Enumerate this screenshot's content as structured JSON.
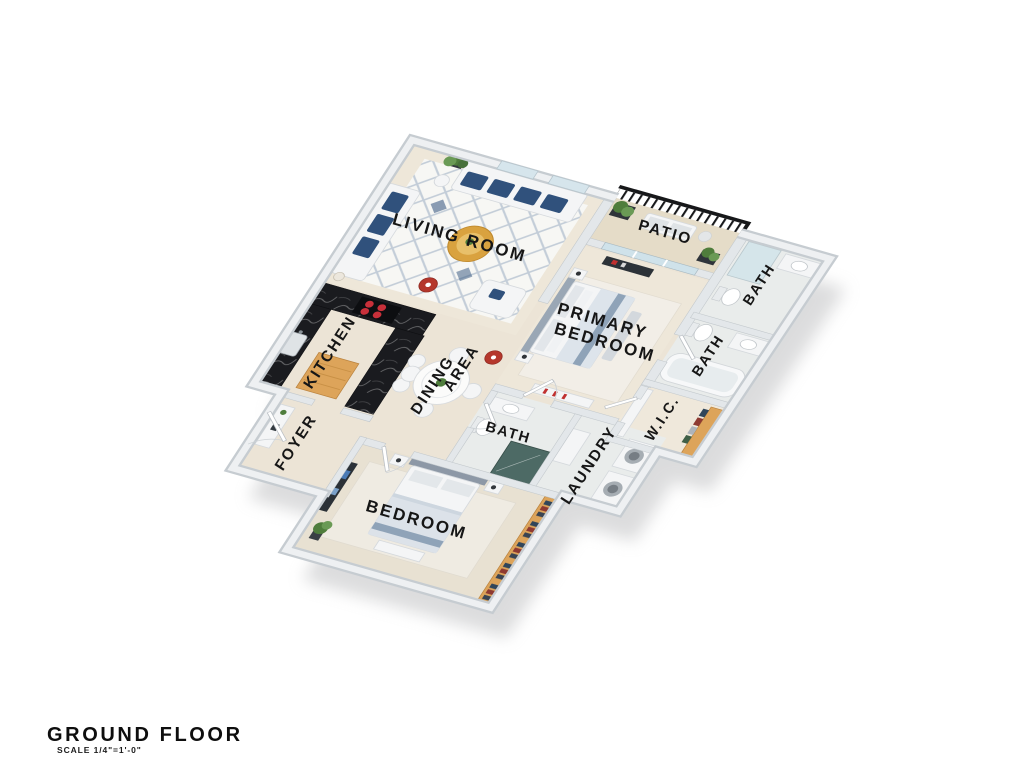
{
  "title_block": {
    "title": "GROUND FLOOR",
    "scale": "SCALE 1/4\"=1'-0\""
  },
  "rooms": [
    {
      "id": "living-room",
      "label": "LIVING ROOM"
    },
    {
      "id": "patio",
      "label": "PATIO"
    },
    {
      "id": "bath-top-right",
      "label": "BATH"
    },
    {
      "id": "bath-right",
      "label": "BATH"
    },
    {
      "id": "primary-bedroom",
      "label": "PRIMARY BEDROOM",
      "line1": "PRIMARY",
      "line2": "BEDROOM"
    },
    {
      "id": "kitchen",
      "label": "KITCHEN"
    },
    {
      "id": "dining-area",
      "label": "DINING AREA",
      "line1": "DINING",
      "line2": "AREA"
    },
    {
      "id": "bath-middle",
      "label": "BATH"
    },
    {
      "id": "wic",
      "label": "W.I.C."
    },
    {
      "id": "laundry",
      "label": "LAUNDRY"
    },
    {
      "id": "foyer",
      "label": "FOYER"
    },
    {
      "id": "bedroom",
      "label": "BEDROOM"
    }
  ],
  "colors": {
    "ink": "#161616",
    "wall": "#dfe3e6",
    "wall-edge": "#c6ccd1",
    "floor": "#ece4d6",
    "floor-light": "#eee7d9",
    "bath-floor": "#e9eceb",
    "bedroom-floor": "#e8e1d2",
    "patio-floor": "#e5dcc8",
    "rug": "#f7f7f4",
    "lattice": "#c3cdd8",
    "navy": "#30517c",
    "gold": "#d9a23f",
    "wood": "#dda45a",
    "counter": "#1a1b1f",
    "railing": "#17181a",
    "accent-red": "#b5372c",
    "plant": "#4f7d3c",
    "glass": "#d3e5ea",
    "shower-dark": "#40605a",
    "shadow": "#b9babc",
    "white-furniture": "#f4f5f6",
    "furniture-stroke": "#d5d9dd"
  }
}
